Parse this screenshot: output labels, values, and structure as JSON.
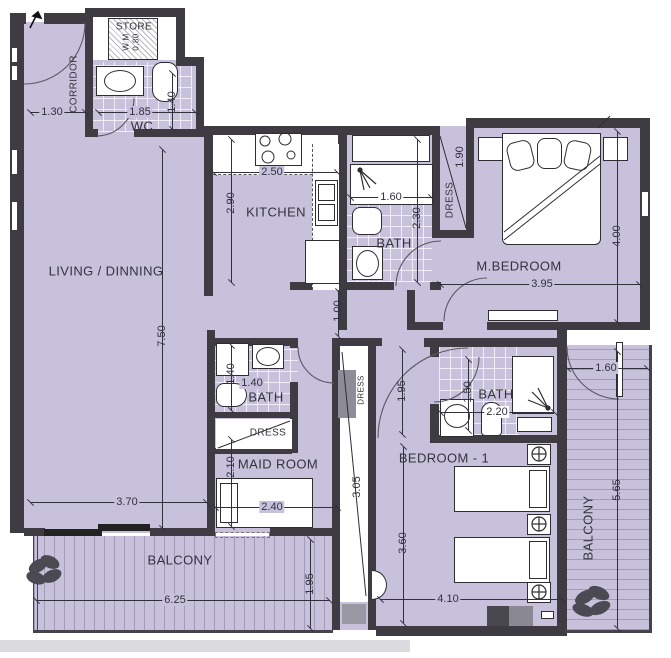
{
  "labels": {
    "store": "STORE",
    "wm": "W.M",
    "wm_dim": "0.80",
    "corridor": "CORRIDOR",
    "wc": "WC",
    "kitchen": "KITCHEN",
    "living": "LIVING / DINNING",
    "bath_top": "BATH",
    "dress_master": "DRESS",
    "mbedroom": "M.BEDROOM",
    "bath_maid": "BATH",
    "dress_maid": "DRESS",
    "maidroom": "MAID ROOM",
    "dress_hall": "DRESS",
    "bath_bed1": "BATH",
    "bedroom1": "BEDROOM - 1",
    "balcony_bottom": "BALCONY",
    "balcony_right": "BALCONY"
  },
  "dims": {
    "entry_130": "1.30",
    "wc_185": "1.85",
    "wc_140": "1.40",
    "kitchen_250": "2.50",
    "kitchen_290": "2.90",
    "bath_160": "1.60",
    "bath_230": "2.30",
    "dress_190": "1.90",
    "mbed_395": "3.95",
    "mbed_400": "4.00",
    "living_750": "7.50",
    "living_370": "3.70",
    "hall_100": "1.00",
    "hall_195": "1.95",
    "maidbath_140v": "1.40",
    "maidbath_140h": "1.40",
    "maid_210": "2.10",
    "maid_240": "2.40",
    "dress_305": "3.05",
    "bed1bath_195": "1.95",
    "bed1bath_150": "1.50",
    "bed1bath_220": "2.20",
    "bed1_360": "3.60",
    "bed1_410": "4.10",
    "balconyb_625": "6.25",
    "balconyb_195": "1.95",
    "balconyr_565": "5.65",
    "balconyr_160": "1.60"
  },
  "colors": {
    "floor": "#c8c1dc",
    "wall": "#3e3c42",
    "linework": "#2d2d33"
  }
}
